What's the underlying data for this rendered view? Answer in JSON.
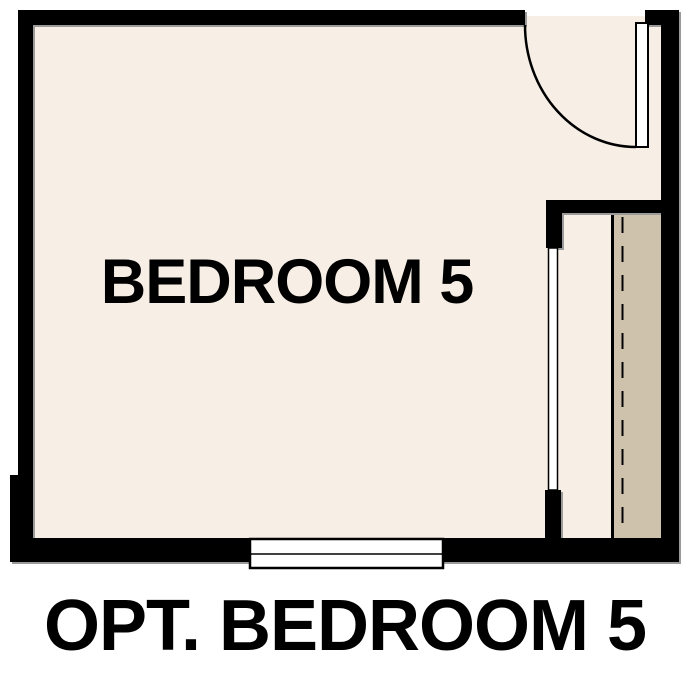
{
  "caption": {
    "label": "OPT. BEDROOM 5"
  },
  "floor_plan": {
    "room_label": "BEDROOM 5",
    "colors": {
      "background": "#ffffff",
      "wall": "#000000",
      "floor": "#f7efe5",
      "closet_floor": "#cec2ac",
      "fixture_fill": "#ffffff",
      "outline": "#000000",
      "text": "#000000"
    }
  }
}
